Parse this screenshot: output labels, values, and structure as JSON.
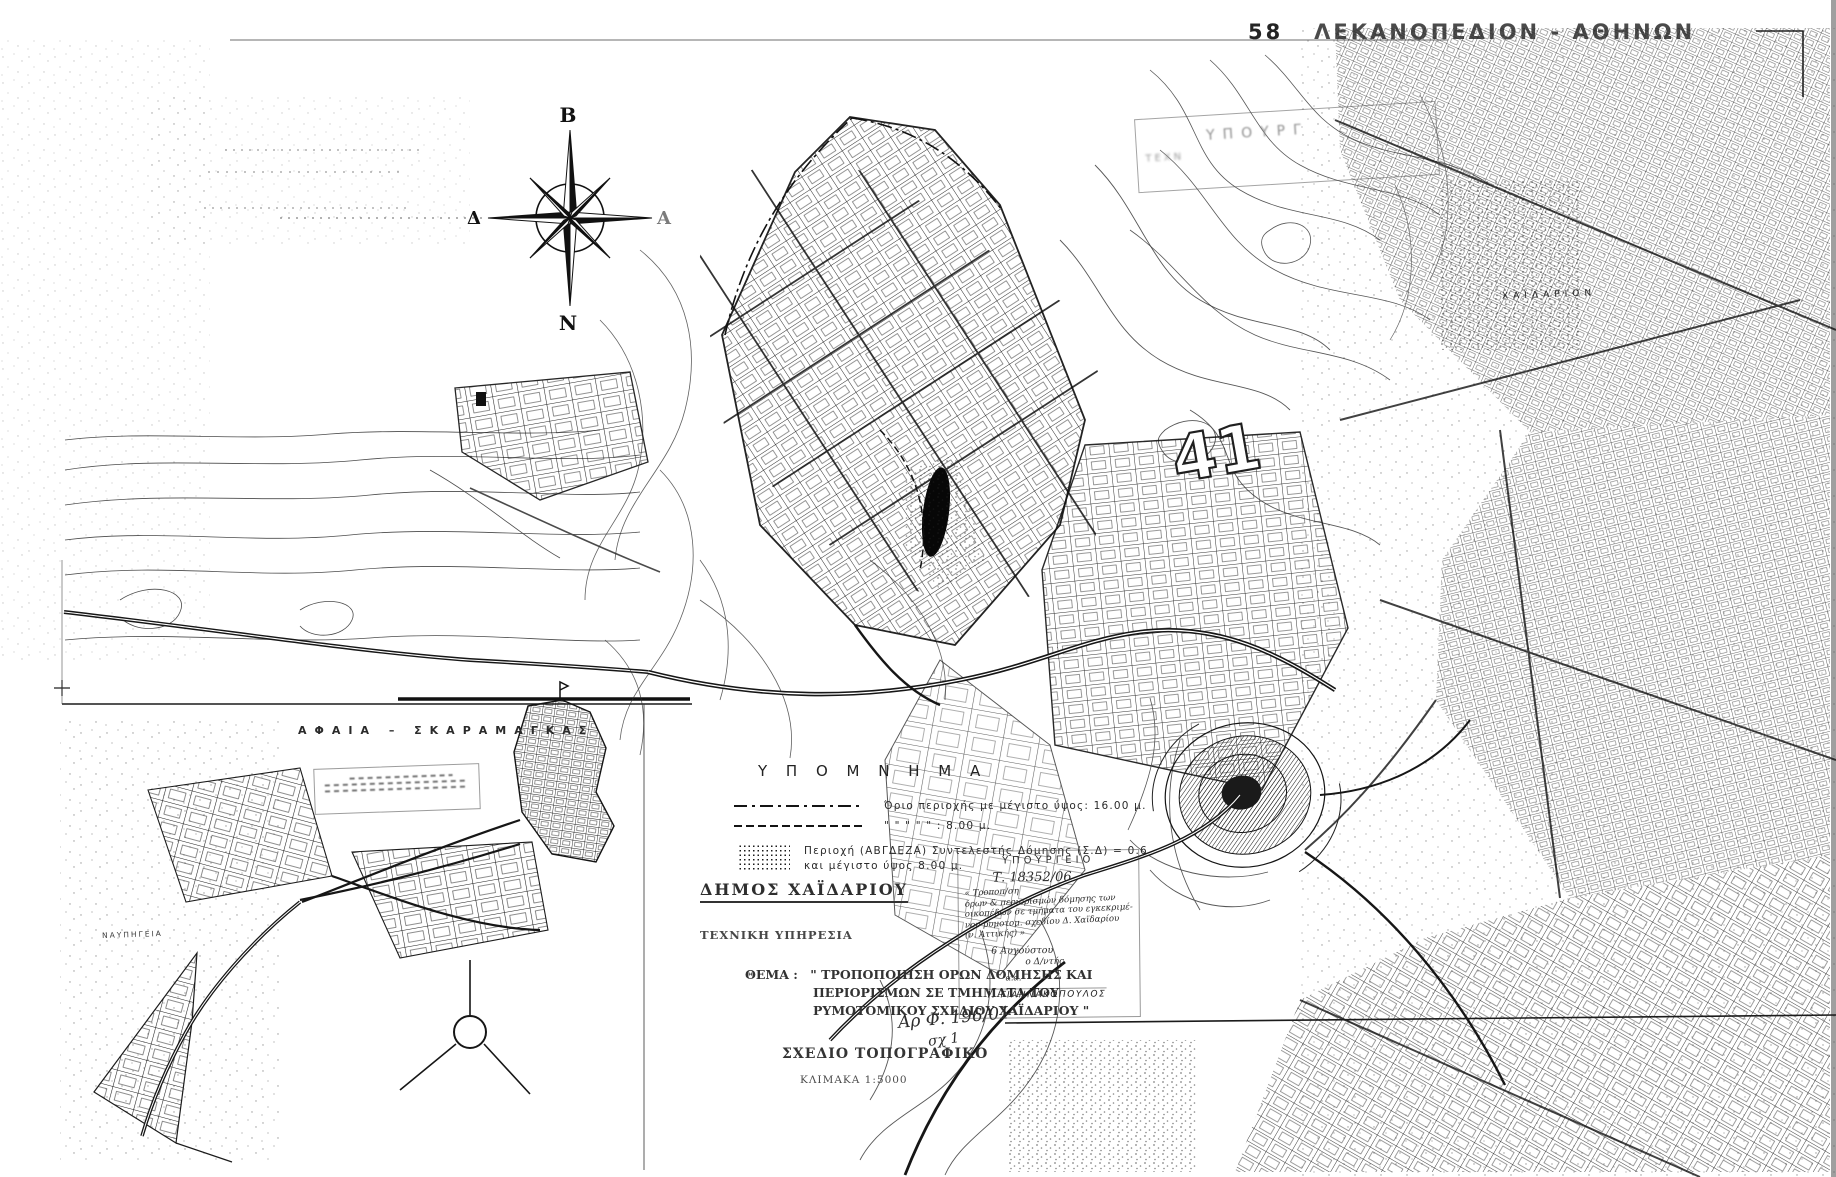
{
  "page": {
    "paper": "#ffffff",
    "ink": "#1b1b1b"
  },
  "sheet": {
    "number": "58",
    "name": "ΛΕΚΑΝΟΠΕΔΙΟΝ - ΑΘΗΝΩΝ"
  },
  "compass": {
    "north": "Β",
    "south": "Ν",
    "west": "Δ",
    "east": "Α"
  },
  "legend": {
    "title": "Υ Π Ο Μ Ν Η Μ Α",
    "item1": "Όριο περιοχής με μέγιστο ύψος: 16.00 μ.",
    "item2": "\"        \"        \"        \"        \"     :  8.00 μ.",
    "item3_line1": "Περιοχή (ΑΒΓΔΕΖΑ) Συντελεστής Δόμησης (Σ.Δ) = 0.6",
    "item3_line2": "και μέγιστο ύψος 8.00 μ."
  },
  "document": {
    "municipality": "ΔΗΜΟΣ ΧΑΪΔΑΡΙΟΥ",
    "service": "ΤΕΧΝΙΚΗ ΥΠΗΡΕΣΙΑ",
    "subject_label": "ΘΕΜΑ :",
    "subject_line1": "\" ΤΡΟΠΟΠΟΙΗΣΗ ΟΡΩΝ ΔΟΜΗΣΗΣ ΚΑΙ",
    "subject_line2": "ΠΕΡΙΟΡΙΣΜΩΝ ΣΕ ΤΜΗΜΑΤΑ ΤΟΥ",
    "subject_line3": "ΡΥΜΟΤΟΜΙΚΟΥ ΣΧΕΔΙΟΥ ΧΑΪΔΑΡΙΟΥ \"",
    "drawing_type": "ΣΧΕΔΙΟ ΤΟΠΟΓΡΑΦΙΚΟ",
    "scale": "ΚΛΙΜΑΚΑ   1:5000",
    "file_note": "Αρ Φ. 196/01",
    "file_note2": "σχ 1"
  },
  "ministry_stamp": {
    "header": "ΥΠΟΥΡΓΕΙΟ",
    "protocol": "Τ. 18352/06",
    "hand1": "« Τροποπ/ση",
    "hand2": "όρων & περιορισμών δόμησης των",
    "hand3": "οικοπέδων σε τμήματα του εγκεκριμέ-",
    "hand4": "νου ρυμοτομ. σχεδίου Δ. Χαϊδαρίου",
    "hand5": "(ν. Αττικής) »",
    "date": "6 Αυγούστου",
    "director": "ο Δ/ντής",
    "sig_prefix": "α.α.",
    "signature": "Ι. ΓΙΑΝΝΑΚΟΠΟΥΛΟΣ"
  },
  "faded_stamp": {
    "line1": "ΥΠΟΥΡΓ",
    "line2": "ΤΕΧΝ"
  },
  "map_labels": {
    "sheet_number": "41",
    "chaidarion": "ΧΑΪΔΑΡΙΟΝ",
    "aphaia_title": "ΑΦΑΙΑ  –  ΣΚΑΡΑΜΑΓΚΑΣ",
    "shipyards": "ΝΑΥΠΗΓΕΙΑ"
  }
}
